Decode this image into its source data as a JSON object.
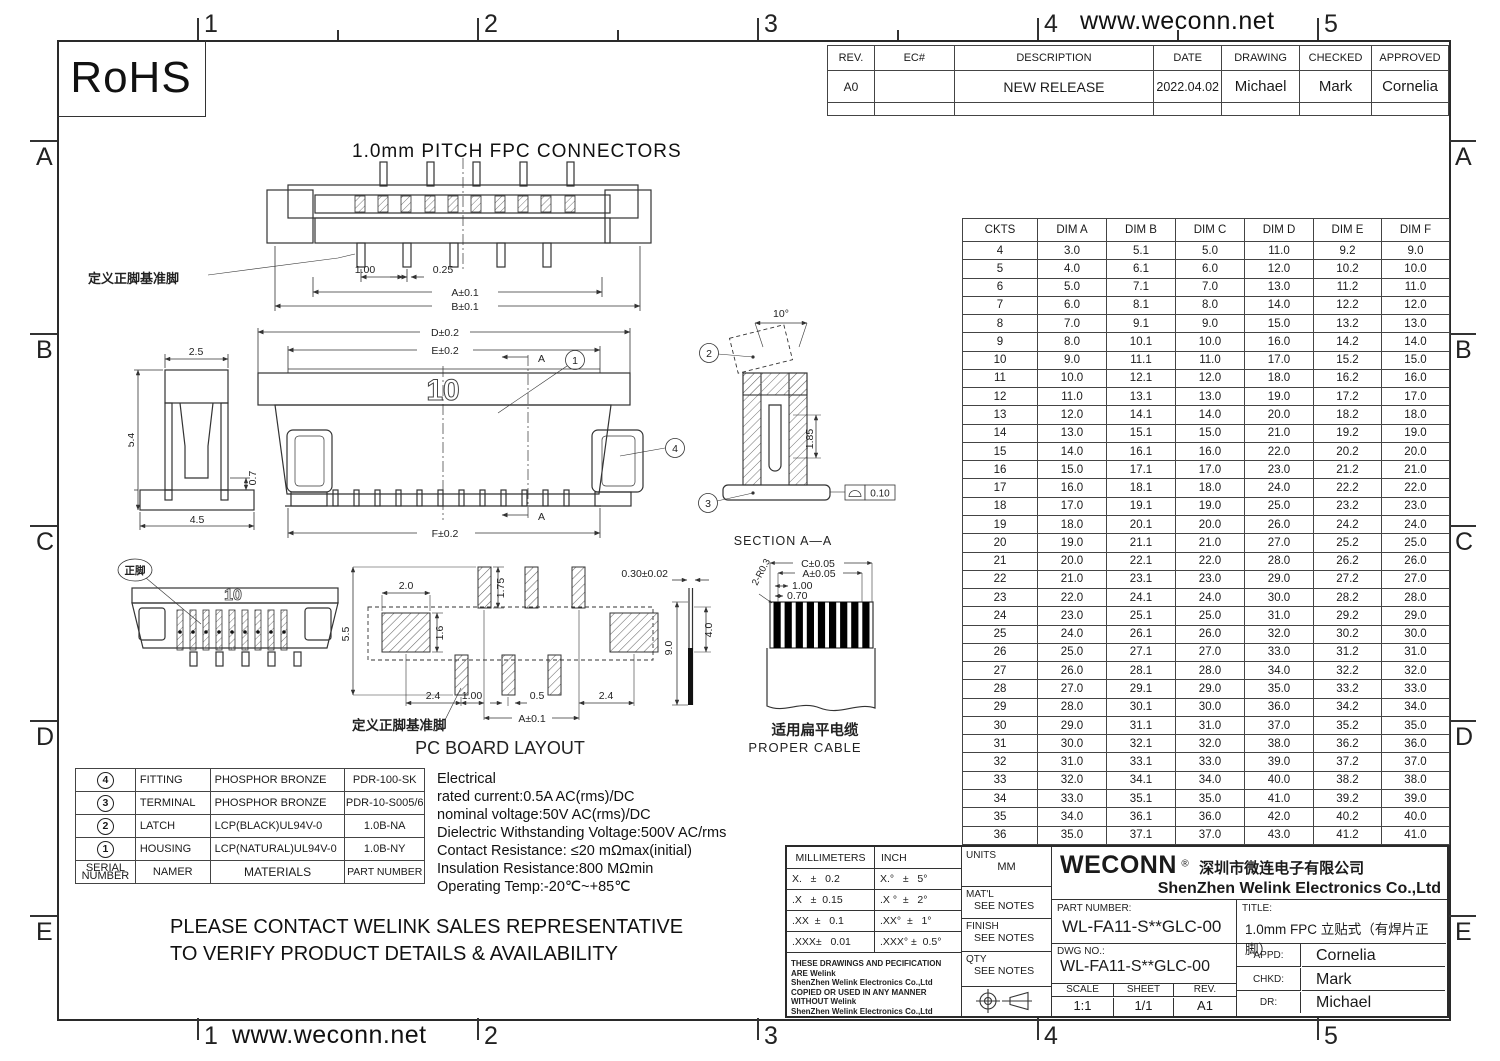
{
  "page": {
    "url_top": "www.weconn.net",
    "url_bottom": "www.weconn.net",
    "rohs_label": "RoHS",
    "zone_numbers": [
      "1",
      "2",
      "3",
      "4",
      "5"
    ],
    "zone_letters": [
      "A",
      "B",
      "C",
      "D",
      "E"
    ]
  },
  "revision_table": {
    "headers": [
      "REV.",
      "EC#",
      "DESCRIPTION",
      "DATE",
      "DRAWING",
      "CHECKED",
      "APPROVED"
    ],
    "row": {
      "rev": "A0",
      "ec": "",
      "description": "NEW RELEASE",
      "date": "2022.04.02",
      "drawing": "Michael",
      "checked": "Mark",
      "approved": "Cornelia"
    }
  },
  "drawing_title": "1.0mm  PITCH  FPC  CONNECTORS",
  "dim_table": {
    "headers": [
      "CKTS",
      "DIM A",
      "DIM B",
      "DIM C",
      "DIM D",
      "DIM E",
      "DIM F"
    ],
    "rows": [
      [
        "4",
        "3.0",
        "5.1",
        "5.0",
        "11.0",
        "9.2",
        "9.0"
      ],
      [
        "5",
        "4.0",
        "6.1",
        "6.0",
        "12.0",
        "10.2",
        "10.0"
      ],
      [
        "6",
        "5.0",
        "7.1",
        "7.0",
        "13.0",
        "11.2",
        "11.0"
      ],
      [
        "7",
        "6.0",
        "8.1",
        "8.0",
        "14.0",
        "12.2",
        "12.0"
      ],
      [
        "8",
        "7.0",
        "9.1",
        "9.0",
        "15.0",
        "13.2",
        "13.0"
      ],
      [
        "9",
        "8.0",
        "10.1",
        "10.0",
        "16.0",
        "14.2",
        "14.0"
      ],
      [
        "10",
        "9.0",
        "11.1",
        "11.0",
        "17.0",
        "15.2",
        "15.0"
      ],
      [
        "11",
        "10.0",
        "12.1",
        "12.0",
        "18.0",
        "16.2",
        "16.0"
      ],
      [
        "12",
        "11.0",
        "13.1",
        "13.0",
        "19.0",
        "17.2",
        "17.0"
      ],
      [
        "13",
        "12.0",
        "14.1",
        "14.0",
        "20.0",
        "18.2",
        "18.0"
      ],
      [
        "14",
        "13.0",
        "15.1",
        "15.0",
        "21.0",
        "19.2",
        "19.0"
      ],
      [
        "15",
        "14.0",
        "16.1",
        "16.0",
        "22.0",
        "20.2",
        "20.0"
      ],
      [
        "16",
        "15.0",
        "17.1",
        "17.0",
        "23.0",
        "21.2",
        "21.0"
      ],
      [
        "17",
        "16.0",
        "18.1",
        "18.0",
        "24.0",
        "22.2",
        "22.0"
      ],
      [
        "18",
        "17.0",
        "19.1",
        "19.0",
        "25.0",
        "23.2",
        "23.0"
      ],
      [
        "19",
        "18.0",
        "20.1",
        "20.0",
        "26.0",
        "24.2",
        "24.0"
      ],
      [
        "20",
        "19.0",
        "21.1",
        "21.0",
        "27.0",
        "25.2",
        "25.0"
      ],
      [
        "21",
        "20.0",
        "22.1",
        "22.0",
        "28.0",
        "26.2",
        "26.0"
      ],
      [
        "22",
        "21.0",
        "23.1",
        "23.0",
        "29.0",
        "27.2",
        "27.0"
      ],
      [
        "23",
        "22.0",
        "24.1",
        "24.0",
        "30.0",
        "28.2",
        "28.0"
      ],
      [
        "24",
        "23.0",
        "25.1",
        "25.0",
        "31.0",
        "29.2",
        "29.0"
      ],
      [
        "25",
        "24.0",
        "26.1",
        "26.0",
        "32.0",
        "30.2",
        "30.0"
      ],
      [
        "26",
        "25.0",
        "27.1",
        "27.0",
        "33.0",
        "31.2",
        "31.0"
      ],
      [
        "27",
        "26.0",
        "28.1",
        "28.0",
        "34.0",
        "32.2",
        "32.0"
      ],
      [
        "28",
        "27.0",
        "29.1",
        "29.0",
        "35.0",
        "33.2",
        "33.0"
      ],
      [
        "29",
        "28.0",
        "30.1",
        "30.0",
        "36.0",
        "34.2",
        "34.0"
      ],
      [
        "30",
        "29.0",
        "31.1",
        "31.0",
        "37.0",
        "35.2",
        "35.0"
      ],
      [
        "31",
        "30.0",
        "32.1",
        "32.0",
        "38.0",
        "36.2",
        "36.0"
      ],
      [
        "32",
        "31.0",
        "33.1",
        "33.0",
        "39.0",
        "37.2",
        "37.0"
      ],
      [
        "33",
        "32.0",
        "34.1",
        "34.0",
        "40.0",
        "38.2",
        "38.0"
      ],
      [
        "34",
        "33.0",
        "35.1",
        "35.0",
        "41.0",
        "39.2",
        "39.0"
      ],
      [
        "35",
        "34.0",
        "36.1",
        "36.0",
        "42.0",
        "40.2",
        "40.0"
      ],
      [
        "36",
        "35.0",
        "37.1",
        "37.0",
        "43.0",
        "41.2",
        "41.0"
      ]
    ]
  },
  "materials_table": {
    "rows": [
      {
        "serial": "4",
        "name": "FITTING",
        "material": "PHOSPHOR BRONZE",
        "part": "PDR-100-SK"
      },
      {
        "serial": "3",
        "name": "TERMINAL",
        "material": "PHOSPHOR BRONZE",
        "part": "PDR-10-S005/6"
      },
      {
        "serial": "2",
        "name": "LATCH",
        "material": "LCP(BLACK)UL94V-0",
        "part": "1.0B-NA"
      },
      {
        "serial": "1",
        "name": "HOUSING",
        "material": "LCP(NATURAL)UL94V-0",
        "part": "1.0B-NY"
      }
    ],
    "footer": {
      "serial_line1": "SERIAL",
      "serial_line2": "NUMBER",
      "name": "NAMER",
      "material": "MATERIALS",
      "part": "PART NUMBER"
    }
  },
  "electrical": {
    "title": "Electrical",
    "lines": [
      "rated current:0.5A AC(rms)/DC",
      "nominal voltage:50V AC(rms)/DC",
      "Dielectric Withstanding Voltage:500V AC/rms",
      "Contact Resistance: ≤20 mΩmax(initial)",
      "Insulation Resistance:800 MΩmin",
      "Operating Temp:-20℃~+85℃"
    ]
  },
  "notes": {
    "line1": "PLEASE CONTACT WELINK SALES REPRESENTATIVE",
    "line2": "TO VERIFY PRODUCT DETAILS & AVAILABILITY"
  },
  "title_block": {
    "tol_header_mm": "MILLIMETERS",
    "tol_header_inch": "INCH",
    "tol_rows": [
      {
        "mm": "X.   ±   0.2",
        "inch": "X.°   ±   5°"
      },
      {
        "mm": ".X   ±  0.15",
        "inch": ".X °  ±   2°"
      },
      {
        "mm": ".XX  ±   0.1",
        "inch": ".XX°  ±   1°"
      },
      {
        "mm": ".XXX±   0.01",
        "inch": ".XXX° ±  0.5°"
      }
    ],
    "legal_lines": [
      "THESE DRAWINGS AND PECIFICATION  ARE Welink",
      "ShenZhen Welink Electronics Co.,Ltd",
      " COPIED OR USED IN ANY MANNER WITHOUT Welink",
      "ShenZhen Welink Electronics Co.,Ltd"
    ],
    "units_label": "UNITS",
    "units_value": "MM",
    "matl_label": "MAT'L",
    "matl_value": "SEE NOTES",
    "finish_label": "FINISH",
    "finish_value": "SEE NOTES",
    "qty_label": "QTY",
    "qty_value": "SEE NOTES",
    "brand": "WECONN",
    "reg_mark": "®",
    "company_cn": "深圳市微连电子有限公司",
    "company_en": "ShenZhen Welink Electronics Co.,Ltd",
    "part_number_label": "PART NUMBER:",
    "part_number": "WL-FA11-S**GLC-00",
    "title_label": "TITLE:",
    "title_value": "1.0mm FPC 立贴式（有焊片正脚）",
    "dwg_no_label": "DWG NO.:",
    "dwg_no": "WL-FA11-S**GLC-00",
    "scale_label": "SCALE",
    "scale_value": "1:1",
    "sheet_label": "SHEET",
    "sheet_value": "1/1",
    "rev_label": "REV.",
    "rev_value": "A1",
    "appd_label": "APPD:",
    "appd_value": "Cornelia",
    "chkd_label": "CHKD:",
    "chkd_value": "Mark",
    "dr_label": "DR:",
    "dr_value": "Michael"
  },
  "views": {
    "top_view": {
      "datum_label": "定义正脚基准脚",
      "dim_pitch": "1.00",
      "dim_pin": "0.25",
      "dim_a": "A±0.1",
      "dim_b": "B±0.1"
    },
    "side_view": {
      "dim_w": "2.5",
      "dim_h": "5.4",
      "dim_base": "4.5",
      "dim_standoff": "0.7"
    },
    "front_view": {
      "marking": "10",
      "dim_d": "D±0.2",
      "dim_e": "E±0.2",
      "dim_f": "F±0.2",
      "section_letter": "A",
      "balloon_housing": "1",
      "balloon_fitting": "4"
    },
    "section_view": {
      "caption": "SECTION  A—A",
      "dim_angle": "10°",
      "dim_depth": "1.85",
      "flatness_value": "0.10",
      "balloon_latch": "2",
      "balloon_terminal": "3"
    },
    "iso_view": {
      "marking": "10",
      "pin_label": "正脚"
    },
    "pcb_view": {
      "caption": "PC BOARD LAYOUT",
      "datum_label": "定义正脚基准脚",
      "dim_height": "5.5",
      "dim_pad_w": "2.0",
      "dim_pad_top": "1.75",
      "dim_pad_h": "1.6",
      "dim_left": "2.4",
      "dim_pitch": "1.00",
      "dim_pin": "0.5",
      "dim_right": "2.4",
      "dim_a": "A±0.1",
      "dim_thickness": "0.30±0.02",
      "dim_exposure": "4.0",
      "dim_length": "9.0"
    },
    "cable_view": {
      "caption_cn": "适用扁平电缆",
      "caption_en": "PROPER CABLE",
      "dim_c": "C±0.05",
      "dim_a": "A±0.05",
      "dim_pitch": "1.00",
      "dim_w": "0.70",
      "dim_r": "2-R0.3"
    }
  }
}
